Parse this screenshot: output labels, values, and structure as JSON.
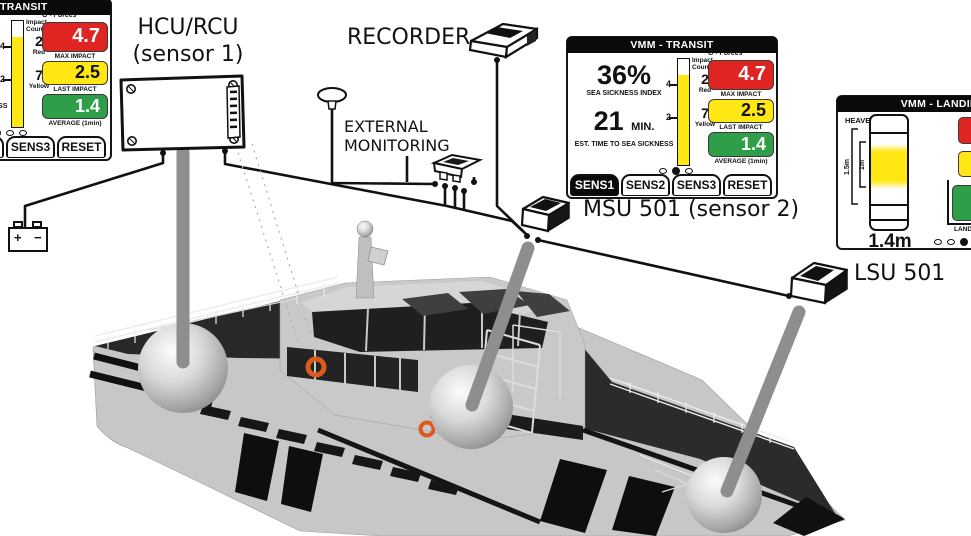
{
  "panels": {
    "transit": {
      "title": "VMM - TRANSIT",
      "sickness_index": "36%",
      "sickness_index_label": "SEA SICKNESS INDEX",
      "time_value": "21",
      "time_unit": "MIN.",
      "time_label": "EST. TIME TO SEA SICKNESS",
      "impact_header_1": "Impact",
      "impact_header_2": "Counts",
      "tick_upper": "4",
      "tick_lower": "2",
      "red_count": "2",
      "red_label": "Red",
      "yellow_count": "7",
      "yellow_label": "Yellow",
      "gforces_label": "G - Forces",
      "max_impact_value": "4.7",
      "max_impact_label": "MAX IMPACT",
      "last_impact_value": "2.5",
      "last_impact_label": "LAST IMPACT",
      "average_value": "1.4",
      "average_label": "AVERAGE (1min)",
      "gauge_fill_style": "height:85%",
      "tabs": [
        "SENS1",
        "SENS2",
        "SENS3",
        "RESET"
      ],
      "active_tab": "SENS1"
    },
    "landing": {
      "title": "VMM - LANDING",
      "heave_label": "HEAVE",
      "range_outer_label": "1.5m",
      "range_inner_label": "1m",
      "heave_value": "1.4m",
      "landing_label": "LANDING"
    }
  },
  "diagram_labels": {
    "hcu_line1": "HCU/RCU",
    "hcu_line2": "(sensor 1)",
    "recorder": "RECORDER",
    "external_line1": "EXTERNAL",
    "external_line2": "MONITORING",
    "msu": "MSU 501 (sensor 2)",
    "lsu": "LSU 501",
    "battery_plus": "+",
    "battery_minus": "−"
  },
  "colors": {
    "alert_red": "#e02421",
    "alert_yellow": "#ffe713",
    "alert_green": "#2f9e49",
    "panel_frame": "#161616",
    "pole_gray": "#8e8e8e",
    "life_ring_orange": "#dd5a1e"
  }
}
